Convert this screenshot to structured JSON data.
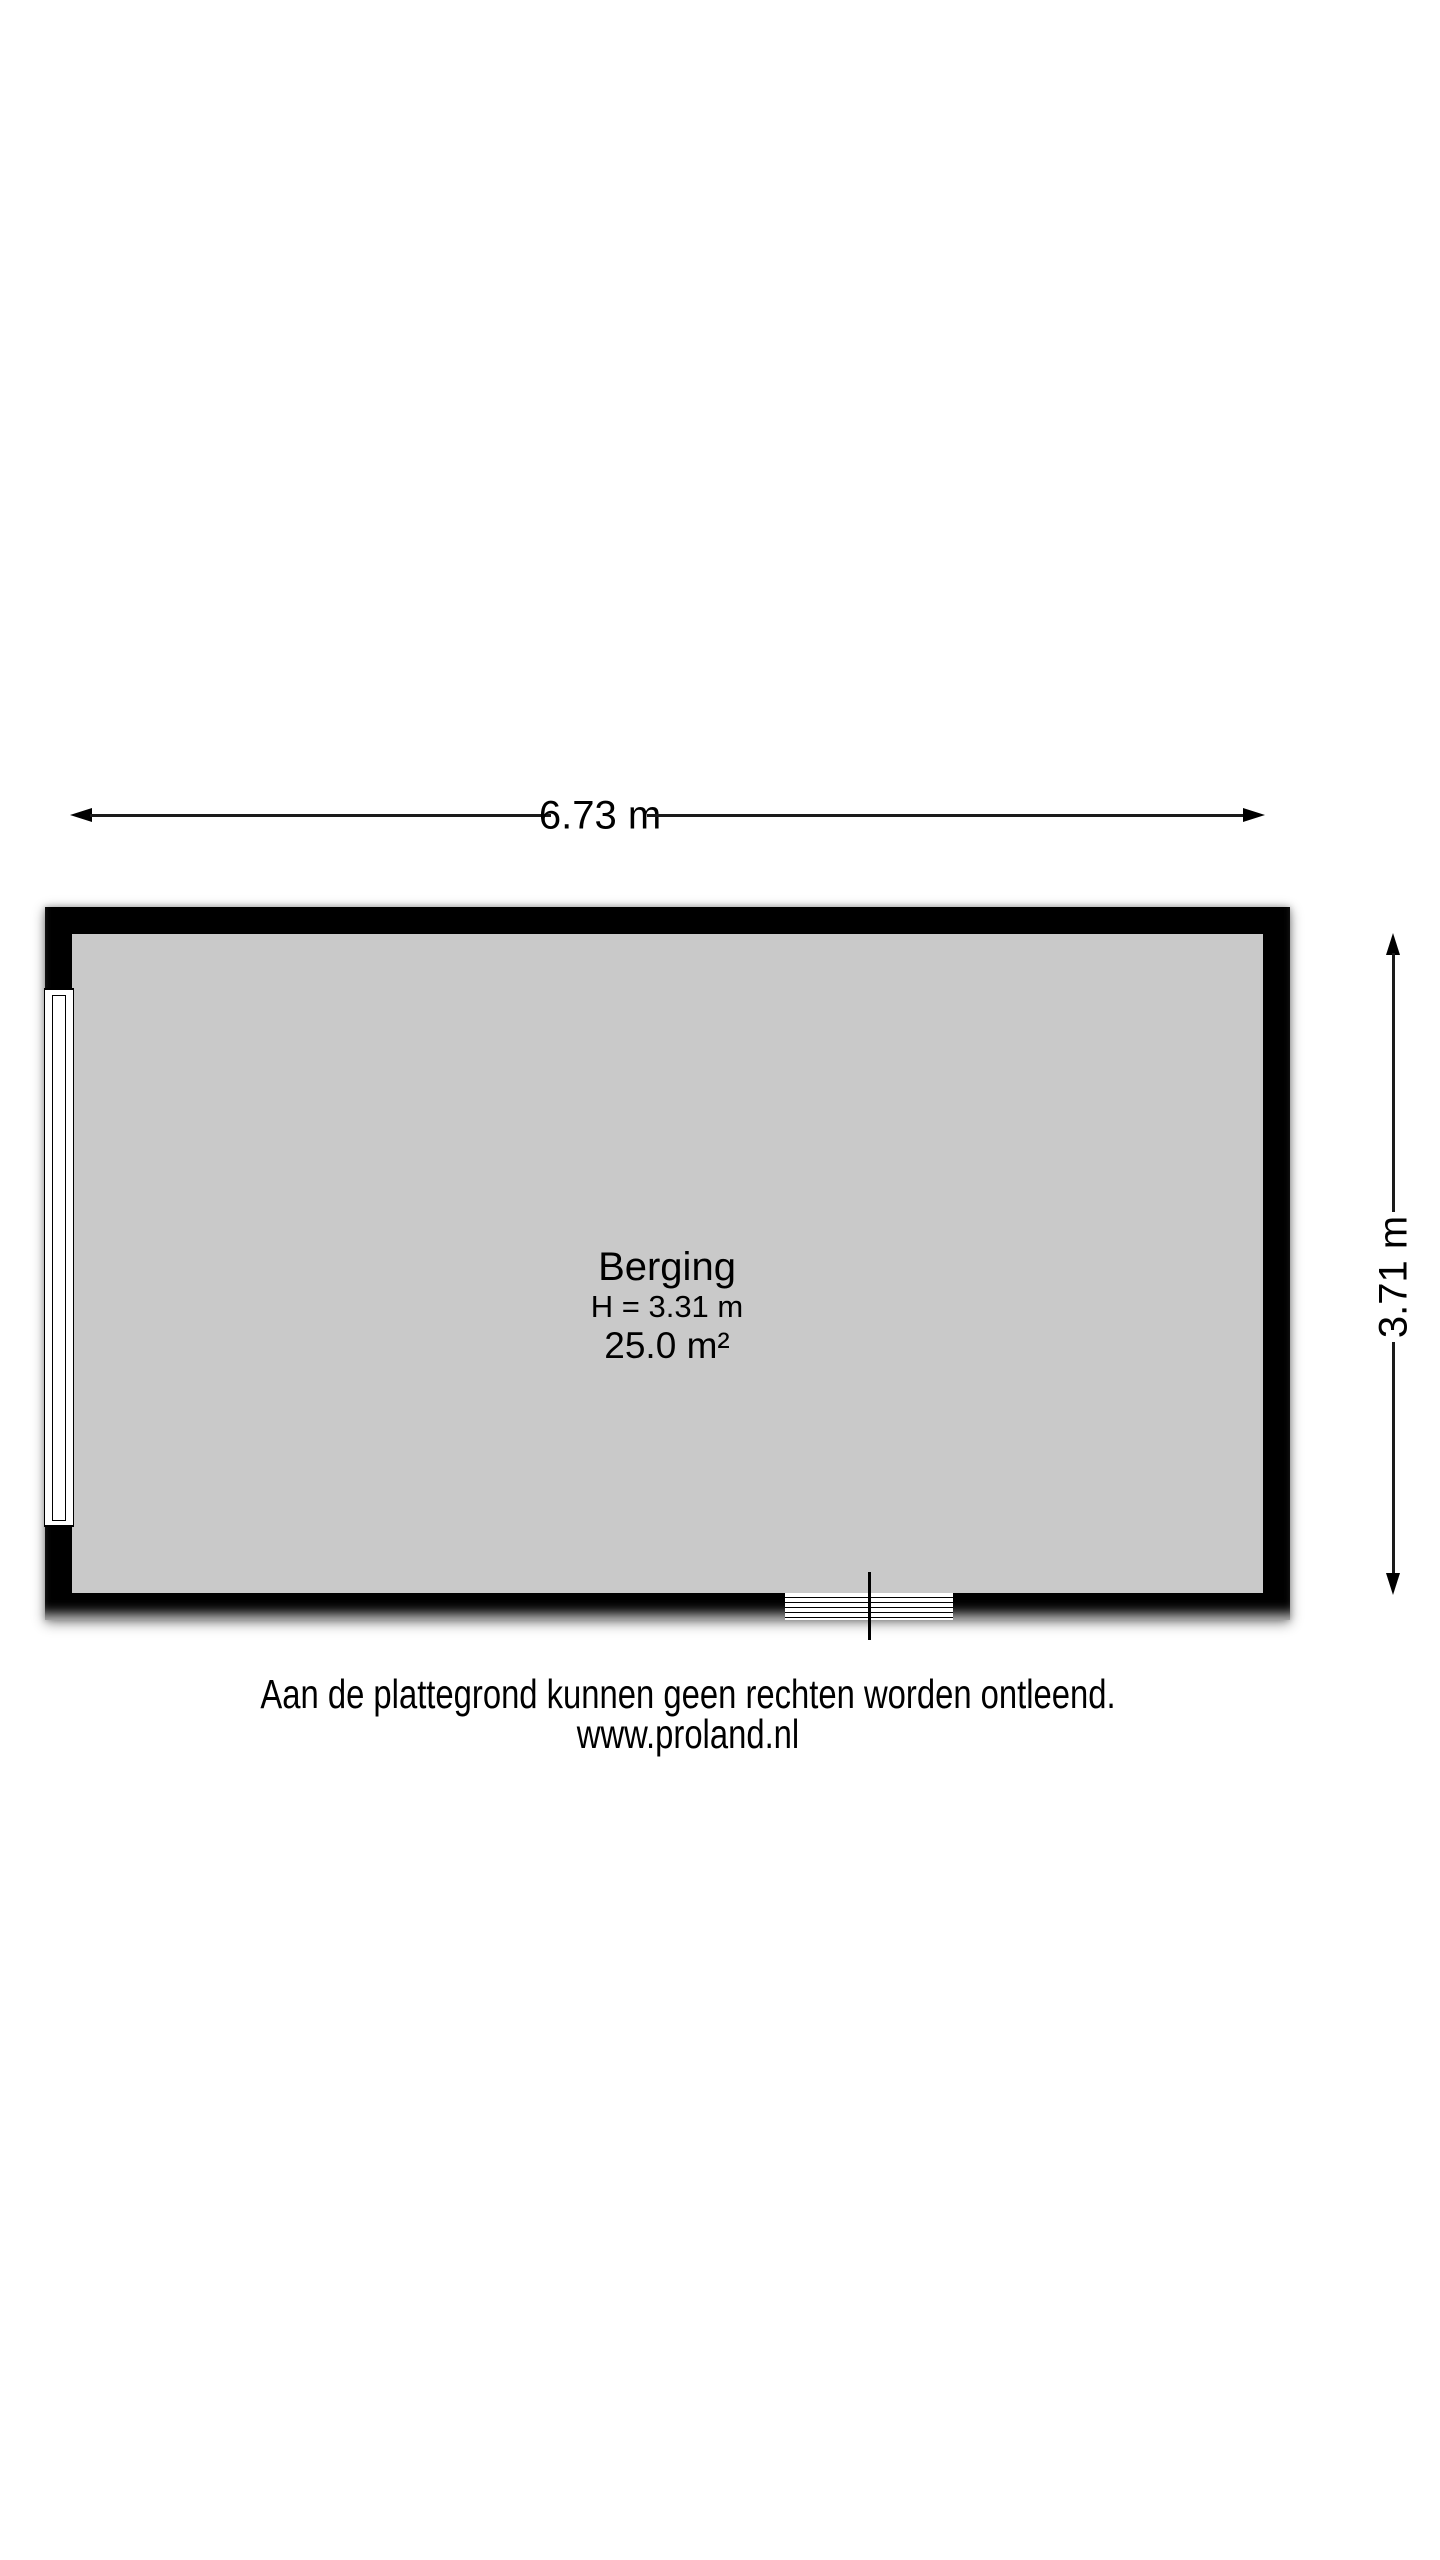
{
  "floorplan": {
    "room": {
      "name": "Berging",
      "ceiling_height": "H = 3.31 m",
      "area": "25.0 m²"
    },
    "dimensions": {
      "width": "6.73 m",
      "height": "3.71 m"
    },
    "symbols": {
      "left_wall": "window",
      "bottom_wall": "door-threshold"
    },
    "colors": {
      "wall": "#000000",
      "floor": "#c9c9c9",
      "background": "#ffffff"
    }
  },
  "footer": {
    "disclaimer": "Aan de plattegrond kunnen geen rechten worden ontleend.",
    "website": "www.proland.nl"
  }
}
